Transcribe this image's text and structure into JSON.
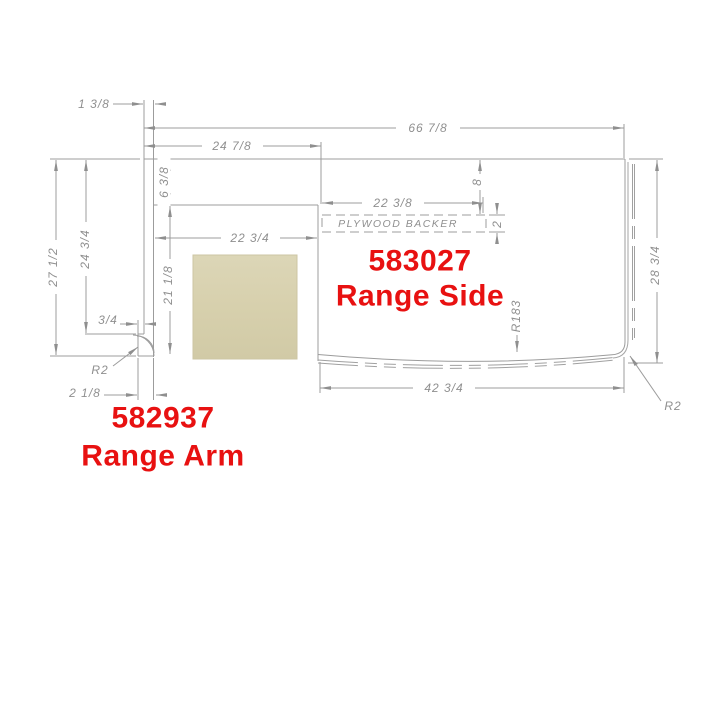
{
  "drawing": {
    "parts": {
      "side": {
        "number": "583027",
        "name": "Range Side"
      },
      "arm": {
        "number": "582937",
        "name": "Range Arm"
      }
    },
    "labels": {
      "backer": "PLYWOOD BACKER"
    },
    "dims": {
      "arm_width_top": "1 3/8",
      "overall_width": "66 7/8",
      "left_section_width": "24 7/8",
      "arm_height": "27 1/2",
      "arm_upper_height": "24 3/4",
      "foot_step_width": "3/4",
      "foot_width": "2 1/8",
      "backsplash_strip_height": "6 3/8",
      "cutout_height": "21 1/8",
      "cutout_width": "22 3/4",
      "backer_width": "22 3/8",
      "backer_offset_height": "8",
      "backer_thickness": "2",
      "side_height": "28 3/4",
      "bottom_width": "42 3/4"
    },
    "radii": {
      "arm_corner": "R2",
      "front_edge": "R183",
      "side_corner": "R2"
    },
    "colors": {
      "label_red": "#e81111",
      "line_gray": "#9c9c9c",
      "text_gray": "#8f8f8f",
      "swatch_fill": "#d7d0ad"
    }
  }
}
